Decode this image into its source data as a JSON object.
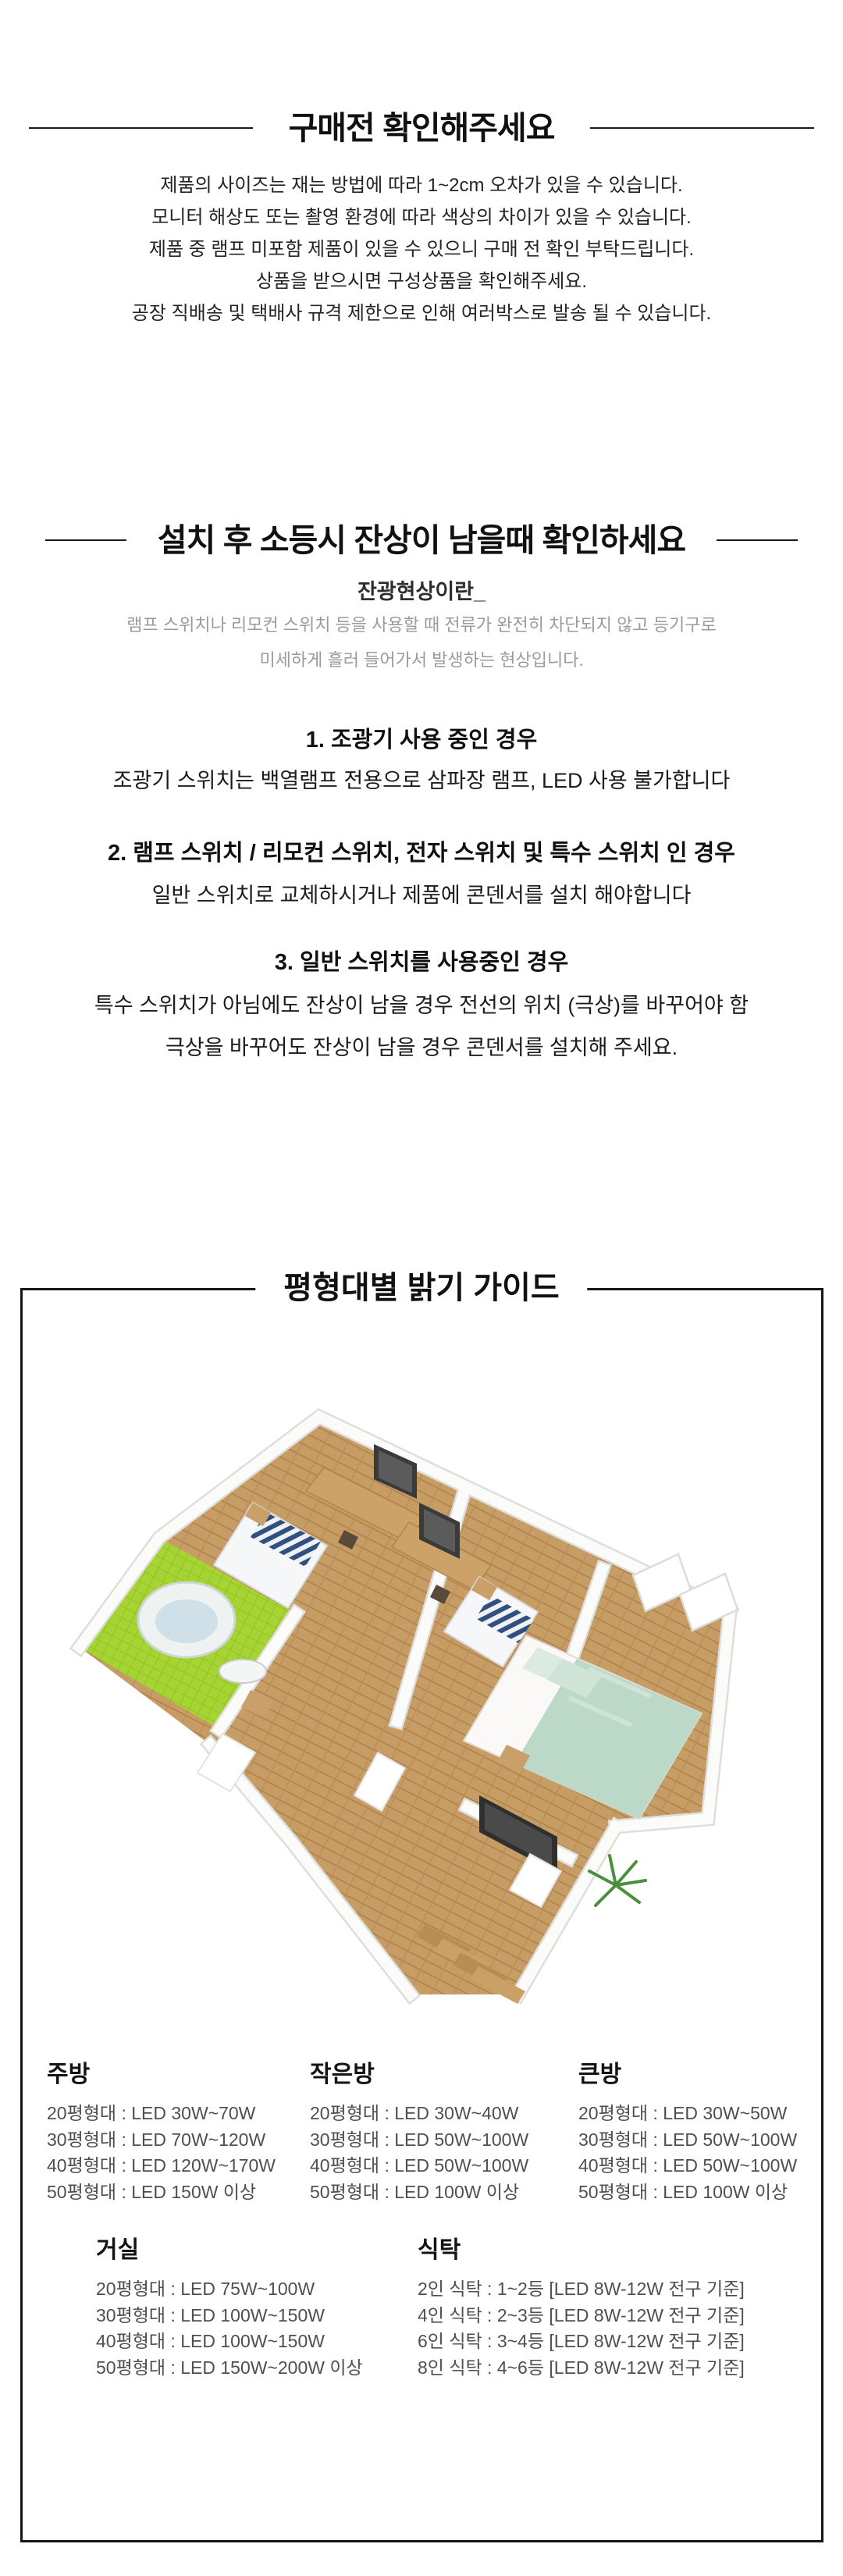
{
  "theme": {
    "background": "#ffffff",
    "text": "#232323",
    "muted_text": "#9b9b9b",
    "rule_and_border": "#161616",
    "floor_wood": "#c79d66",
    "bathroom_tile_green": "#a6d432",
    "bed_stripe_navy": "#31507e",
    "master_bed_mint": "#bcd9c8"
  },
  "notice": {
    "title": "구매전 확인해주세요",
    "lines": [
      "제품의 사이즈는 재는 방법에 따라 1~2cm 오차가 있을 수 있습니다.",
      "모니터 해상도 또는 촬영 환경에 따라 색상의 차이가 있을 수 있습니다.",
      "제품 중 램프 미포함 제품이 있을 수 있으니 구매 전 확인 부탁드립니다.",
      "상품을 받으시면 구성상품을 확인해주세요.",
      "공장 직배송 및 택배사 규격 제한으로 인해 여러박스로 발송 될 수 있습니다."
    ]
  },
  "afterglow": {
    "title": "설치 후 소등시 잔상이 남을때 확인하세요",
    "subtitle": "잔광현상이란_",
    "description": [
      "램프 스위치나 리모컨 스위치 등을 사용할 때 전류가 완전히 차단되지 않고 등기구로",
      "미세하게 흘러 들어가서 발생하는 현상입니다."
    ],
    "cases": [
      {
        "heading": "1. 조광기 사용 중인 경우",
        "lines": [
          "조광기 스위치는 백열램프 전용으로 삼파장 램프, LED 사용 불가합니다"
        ]
      },
      {
        "heading": "2. 램프 스위치 / 리모컨 스위치, 전자 스위치 및 특수 스위치 인 경우",
        "lines": [
          "일반 스위치로 교체하시거나 제품에 콘덴서를 설치 해야합니다"
        ]
      },
      {
        "heading": "3. 일반 스위치를 사용중인 경우",
        "lines": [
          "특수 스위치가 아님에도 잔상이 남을 경우 전선의 위치 (극상)를 바꾸어야 함",
          "극상을 바꾸어도 잔상이 남을 경우 콘덴서를 설치해 주세요."
        ]
      }
    ]
  },
  "guide": {
    "title": "평형대별 밝기 가이드",
    "rooms": [
      {
        "name": "주방",
        "items": [
          "20평형대 : LED 30W~70W",
          "30평형대 : LED 70W~120W",
          "40평형대 : LED 120W~170W",
          "50평형대 : LED 150W 이상"
        ]
      },
      {
        "name": "작은방",
        "items": [
          "20평형대 : LED 30W~40W",
          "30평형대 : LED 50W~100W",
          "40평형대 : LED 50W~100W",
          "50평형대 : LED 100W 이상"
        ]
      },
      {
        "name": "큰방",
        "items": [
          "20평형대 : LED 30W~50W",
          "30평형대 : LED 50W~100W",
          "40평형대 : LED 50W~100W",
          "50평형대 : LED 100W 이상"
        ]
      },
      {
        "name": "거실",
        "items": [
          "20평형대 : LED 75W~100W",
          "30평형대 : LED 100W~150W",
          "40평형대 : LED 100W~150W",
          "50평형대 : LED 150W~200W 이상"
        ]
      },
      {
        "name": "식탁",
        "items": [
          "2인 식탁 : 1~2등 [LED 8W-12W 전구 기준]",
          "4인 식탁 : 2~3등 [LED 8W-12W 전구 기준]",
          "6인 식탁 : 3~4등 [LED 8W-12W 전구 기준]",
          "8인 식탁 : 4~6등 [LED 8W-12W 전구 기준]"
        ]
      }
    ]
  }
}
